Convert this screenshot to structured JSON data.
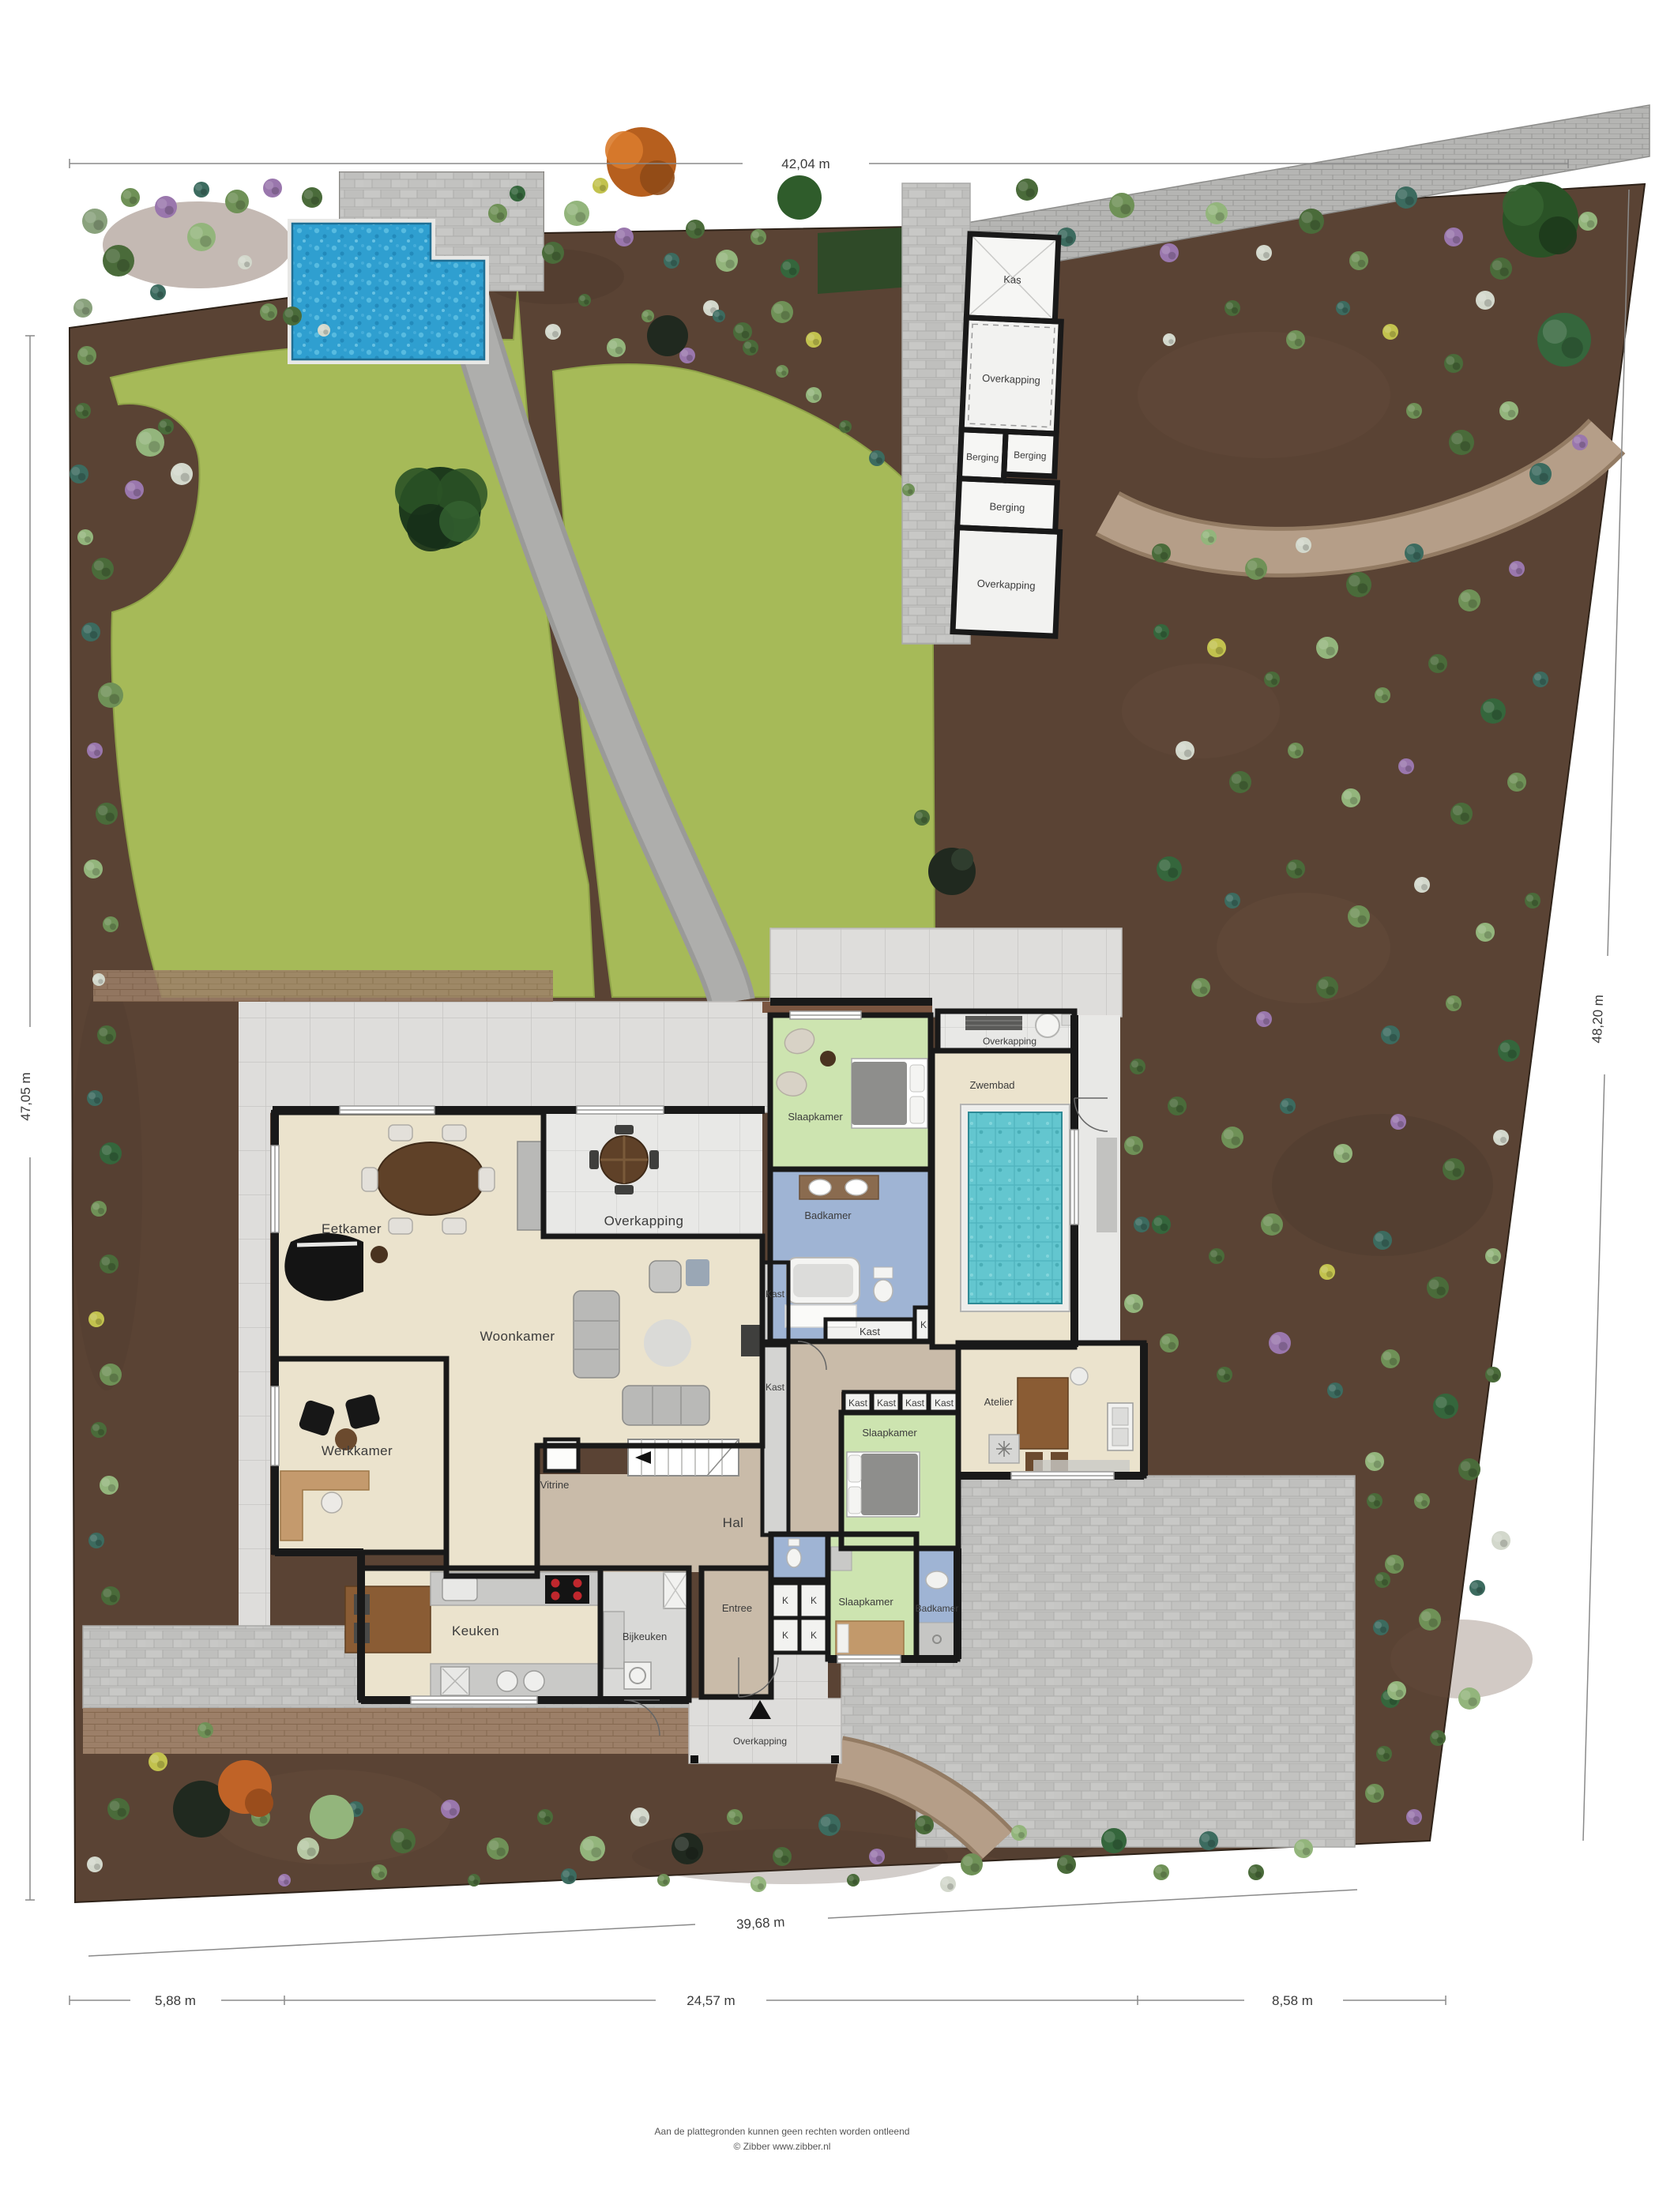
{
  "plan_type": "site-plan",
  "dimensions": {
    "top": "42,04 m",
    "left": "47,05 m",
    "right": "48,20 m",
    "bottom": "39,68 m",
    "seg_left": "5,88 m",
    "seg_mid": "24,57 m",
    "seg_right": "8,58 m"
  },
  "rooms": {
    "kas": "Kas",
    "overkapping": "Overkapping",
    "berging": "Berging",
    "zwembad": "Zwembad",
    "slaapkamer": "Slaapkamer",
    "badkamer": "Badkamer",
    "eetkamer": "Eetkamer",
    "woonkamer": "Woonkamer",
    "werkkamer": "Werkkamer",
    "keuken": "Keuken",
    "bijkeuken": "Bijkeuken",
    "entree": "Entree",
    "hal": "Hal",
    "vitrine": "Vitrine",
    "atelier": "Atelier",
    "kast": "Kast",
    "kast_short": "K"
  },
  "footer": {
    "disclaimer": "Aan de plattegronden kunnen geen rechten worden ontleend",
    "credit": "© Zibber www.zibber.nl"
  },
  "colors": {
    "soil": "#5a4334",
    "lawn": "#a6ba58",
    "outdoor_pool": "#2f9fd0",
    "indoor_pool": "#63c6cf",
    "room_cream": "#ebe3cd",
    "room_green": "#cde4b0",
    "room_blue": "#9fb4d4",
    "hal_tan": "#c9bba9",
    "paving": "#c3c3c1",
    "wall": "#191919"
  }
}
